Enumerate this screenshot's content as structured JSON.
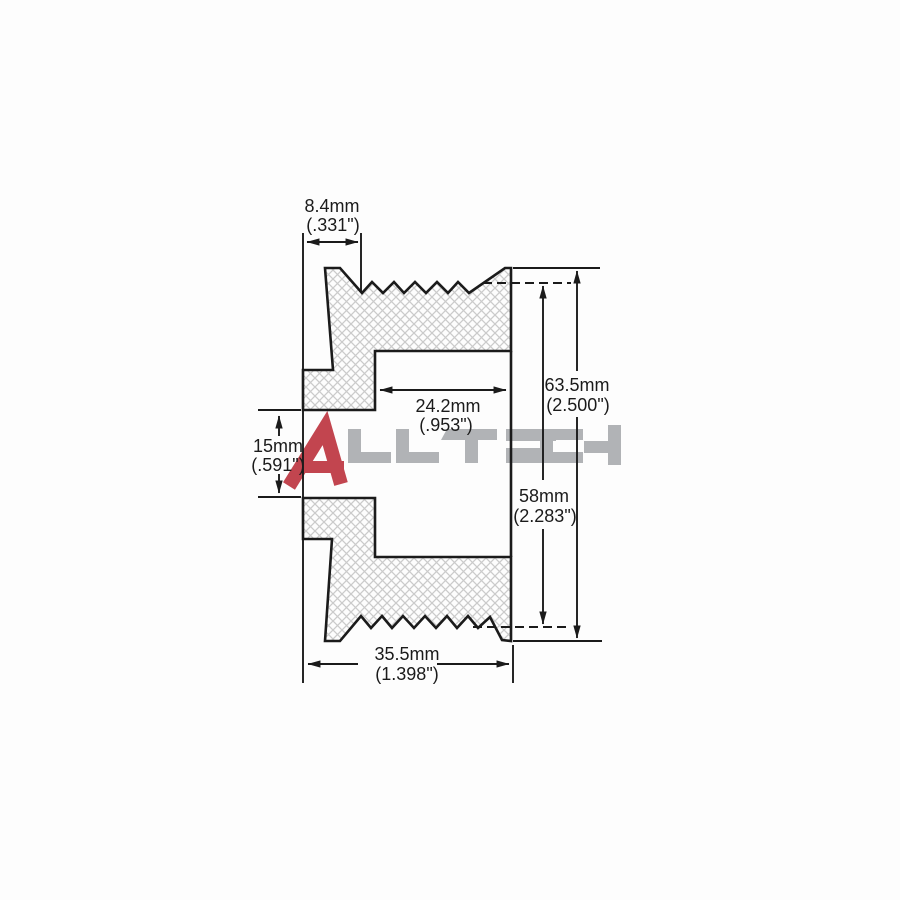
{
  "title": "Pulley cross-section technical drawing",
  "watermark": {
    "letter_a": "A",
    "rest": "LLTECH",
    "color_a": "#c2454f",
    "color_rest": "#b1b3b6"
  },
  "drawing": {
    "line_color": "#1b1b1b",
    "hatch_color": "#cbcbcb",
    "background": "#fdfdfd"
  },
  "dimensions": {
    "groove_offset": {
      "mm": "8.4mm",
      "inch": "(.331\")"
    },
    "recess_width": {
      "mm": "24.2mm",
      "inch": "(.953\")"
    },
    "outer_diameter": {
      "mm": "63.5mm",
      "inch": "(2.500\")"
    },
    "rib_diameter": {
      "mm": "58mm",
      "inch": "(2.283\")"
    },
    "bore_diameter": {
      "mm": "15mm",
      "inch": "(.591\")"
    },
    "overall_width": {
      "mm": "35.5mm",
      "inch": "(1.398\")"
    }
  }
}
